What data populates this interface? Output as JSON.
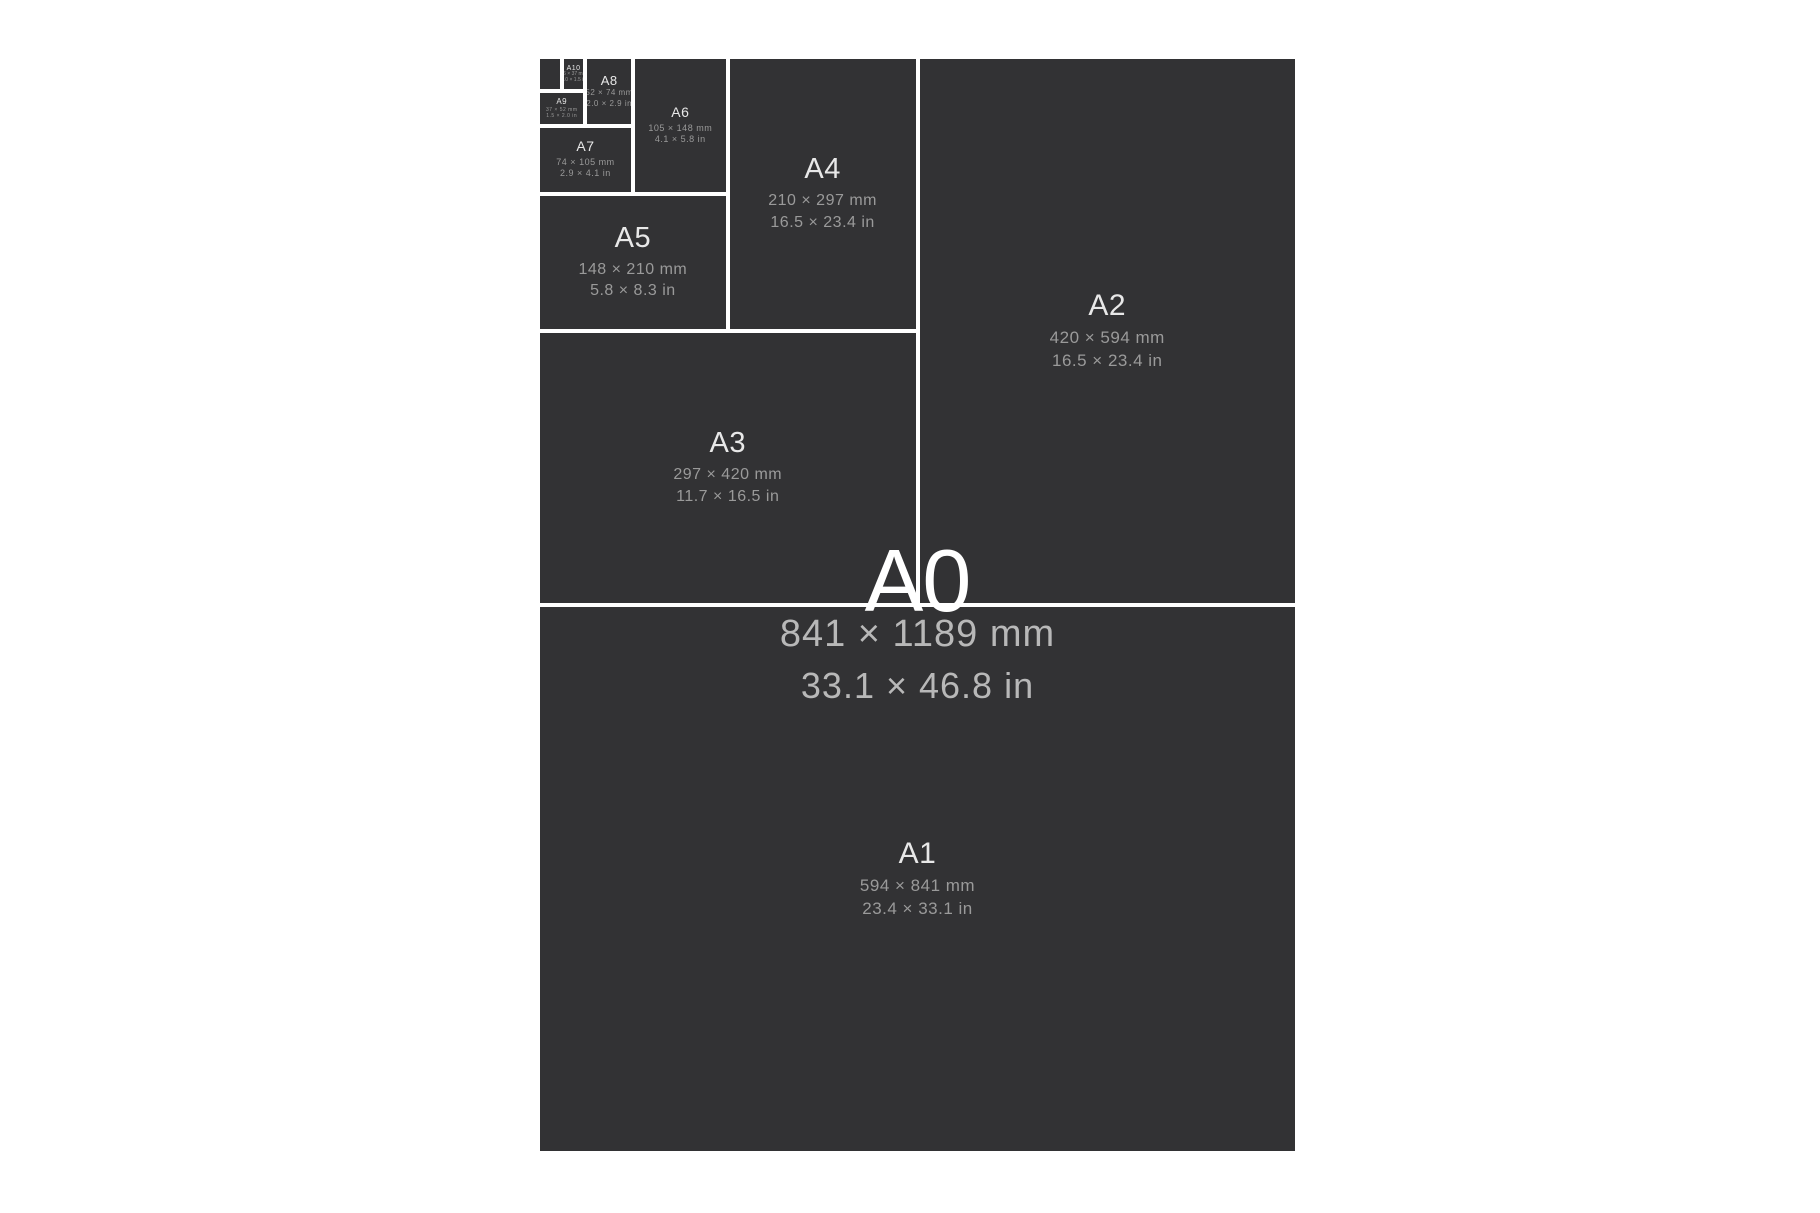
{
  "colors": {
    "page_background": "#ffffff",
    "sheet_fill": "#323234",
    "divider": "#ffffff",
    "a0_title_text": "#ffffff",
    "a0_dimension_text": "#b8b8b8",
    "label_text": "#e8e8e8",
    "dimension_text": "#9a9a9a"
  },
  "sizes": {
    "a0": {
      "label": "A0",
      "mm": "841 × 1189 mm",
      "inch": "33.1 × 46.8 in"
    },
    "a1": {
      "label": "A1",
      "mm": "594 × 841 mm",
      "inch": "23.4 × 33.1 in"
    },
    "a2": {
      "label": "A2",
      "mm": "420 × 594 mm",
      "inch": "16.5 × 23.4 in"
    },
    "a3": {
      "label": "A3",
      "mm": "297 × 420 mm",
      "inch": "11.7 × 16.5 in"
    },
    "a4": {
      "label": "A4",
      "mm": "210 × 297 mm",
      "inch": "16.5 × 23.4 in"
    },
    "a5": {
      "label": "A5",
      "mm": "148 × 210 mm",
      "inch": "5.8 × 8.3 in"
    },
    "a6": {
      "label": "A6",
      "mm": "105 × 148 mm",
      "inch": "4.1 × 5.8 in"
    },
    "a7": {
      "label": "A7",
      "mm": "74 × 105 mm",
      "inch": "2.9 × 4.1 in"
    },
    "a8": {
      "label": "A8",
      "mm": "52 × 74 mm",
      "inch": "2.0 × 2.9 in"
    },
    "a9": {
      "label": "A9",
      "mm": "37 × 52 mm",
      "inch": "1.5 × 2.0 in"
    },
    "a10": {
      "label": "A10",
      "mm": "26 × 37 mm",
      "inch": "1.0 × 1.5 in"
    }
  }
}
